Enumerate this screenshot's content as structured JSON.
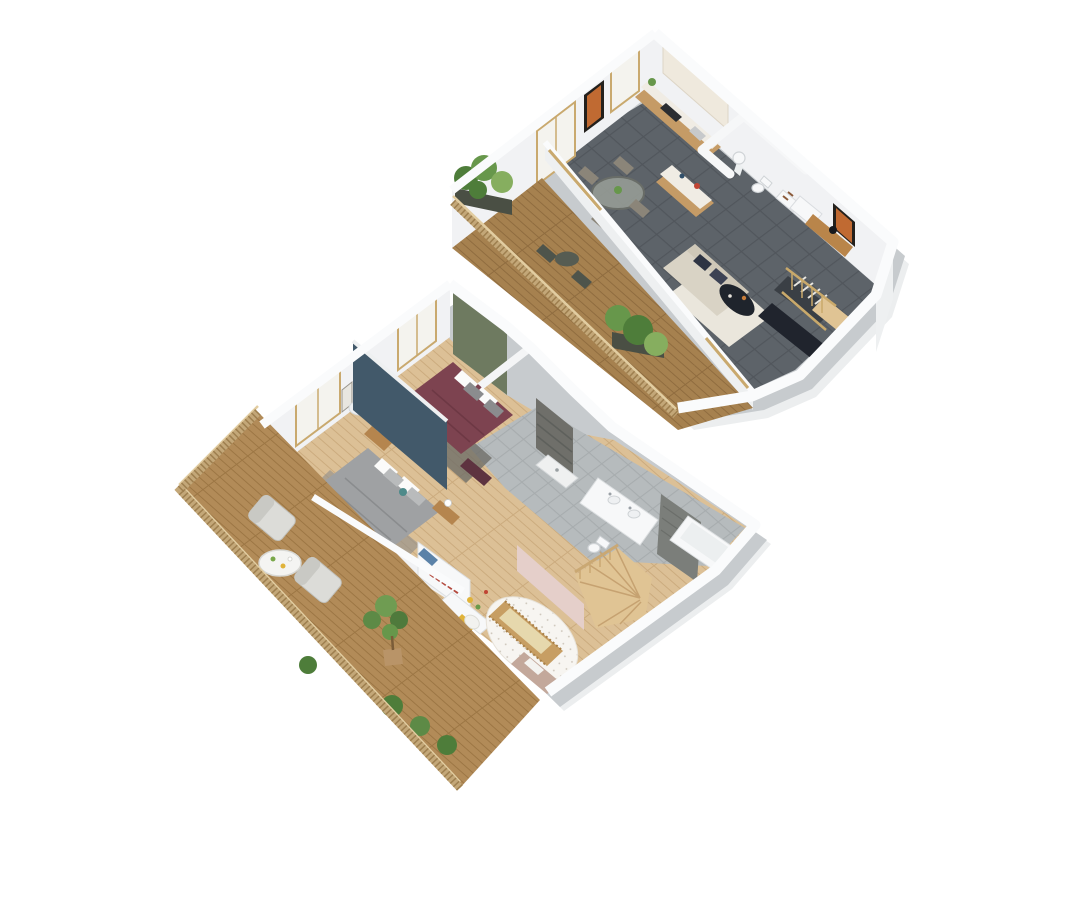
{
  "scene": {
    "type": "3d-floor-plan-render",
    "description": "Isometric 3D render of a two-storey duplex apartment, two floor plates on a white background",
    "background": "#ffffff"
  },
  "colors": {
    "background": "#ffffff",
    "wall_top": "#fafbfc",
    "wall_face": "#f1f2f4",
    "wall_side": "#c7cbce",
    "tile_floor": "#5d6369",
    "tile_grout": "#51565c",
    "bath_tile": "#b6bbbd",
    "bath_grout": "#a7acae",
    "oak_floor": "#dcc096",
    "oak_stripe": "#cbab7e",
    "deck_wood": "#a6814f",
    "deck_stripe": "#8f6c3f",
    "deck_wood_lower": "#b28b58",
    "deck_stripe_lower": "#9c7644",
    "railing_wood": "#c3a778",
    "railing_slat": "#9e7f4f",
    "railing_top": "#e2cda1",
    "green_wall": "#6e7a60",
    "teal_wall": "#42596a",
    "pink_wall": "#e5cfca",
    "maroon_bed": "#7d4350",
    "gray_bed": "#9fa1a3",
    "rug_dark": "#6f6e68",
    "rug_gray": "#93918c",
    "sofa": "#d9d3c5",
    "sofa_back": "#cfc8b8",
    "pillow_navy": "#2e3443",
    "area_rug": "#eae6dc",
    "coffee_table": "#1f242c",
    "media_bench": "#20242d",
    "dining_chair": "#8b8579",
    "kitchen_wood": "#c59b66",
    "cabinet_cream": "#efe9dd",
    "counter_white": "#f0ece4",
    "stairs_wood": "#e0c494",
    "stair_dark": "#3a3f45",
    "crib_wood": "#c79e63",
    "crib_mattress": "#e6d8ad",
    "dresser": "#c3a89b",
    "lounge_chair": "#dcdcd8",
    "table_white": "#f4f4f2",
    "plant_dark": "#4e7d3a",
    "plant_mid": "#67974b",
    "plant_light": "#86ae5f",
    "pot": "#b99468",
    "fixture_white": "#f7f8f9",
    "fixture_shade": "#e6e9eb",
    "glass": "#f4f3ee",
    "frame_tan": "#c9a96e",
    "art_orange": "#c06a32",
    "accent_red": "#c04434",
    "accent_yellow": "#e0b33a",
    "accent_teal": "#4e8a8a",
    "accent_blue": "#5b82a8",
    "shower_stone": "#6f6f6a",
    "tile_dark_band": "#7b7e7a"
  },
  "upper_floor": {
    "label": "Upper floor - living level",
    "position": "top-right of image",
    "rooms": [
      "terrace",
      "dining-area",
      "kitchen",
      "guest-wc",
      "hallway",
      "living-area",
      "staircase"
    ],
    "furniture": [
      "glass-dining-table",
      "dining-chairs-x4",
      "kitchen-cabinets",
      "kitchen-island",
      "pedestal-washbasin",
      "toilet",
      "shelf-unit",
      "wardrobe",
      "sofa",
      "coffee-table",
      "media-bench",
      "area-rug",
      "desk",
      "record-player",
      "wall-art-x2",
      "bistro-table",
      "bistro-chairs-x2",
      "terrace-planters-x2",
      "open-staircase"
    ]
  },
  "lower_floor": {
    "label": "Lower floor - bedroom level",
    "position": "bottom-left of image",
    "rooms": [
      "terrace",
      "bedroom-maroon",
      "bedroom-gray",
      "shower-room",
      "bathroom",
      "nursery",
      "hallway",
      "staircase"
    ],
    "furniture": [
      "double-bed-maroon",
      "double-bed-gray",
      "nightstands",
      "table-lamps",
      "console-table",
      "bookshelf-closet",
      "kids-desk",
      "crib",
      "round-nursery-rug",
      "changing-dresser",
      "pouf",
      "double-sink-vanity",
      "bathtub",
      "toilet",
      "shower-tray",
      "winder-staircase",
      "lounge-chairs-x2",
      "round-terrace-table",
      "potted-tree",
      "bush-planters"
    ]
  }
}
